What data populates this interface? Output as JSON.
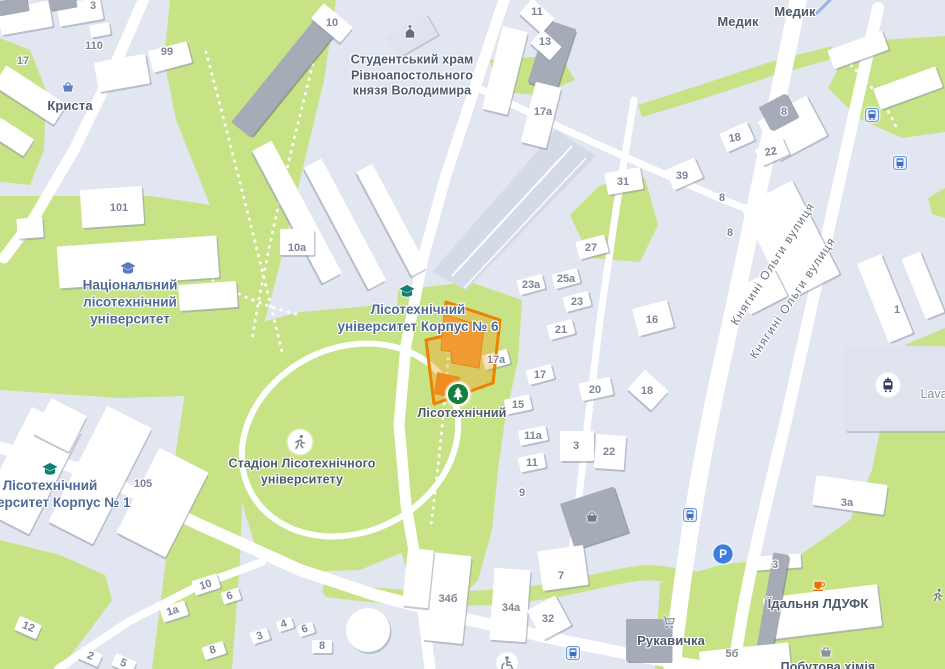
{
  "map": {
    "colors": {
      "background": "#e2e6f1",
      "green": "#c7e386",
      "road": "#ffffff",
      "building": "#ffffff",
      "building_dark": "#a6abb8",
      "tram_corridor": "#d5dae7",
      "selected_stroke": "#ee8100",
      "selected_fill": "rgba(244,160,36,0.38)",
      "selected_building": "#f09c33",
      "poi_text": "#4d5a6b",
      "university_text": "#4f6a97",
      "number_text": "#7f8596"
    },
    "poi_labels": [
      {
        "name": "poi-krysta",
        "text": "Криста",
        "x": 70,
        "y": 106,
        "size": 13,
        "cls": "poi"
      },
      {
        "name": "poi-student-church",
        "text": "Студентський храм\nРівноапостольного\nкнязя Володимира",
        "x": 412,
        "y": 76,
        "size": 12.5,
        "cls": "poi"
      },
      {
        "name": "poi-medyk-1",
        "text": "Медик",
        "x": 738,
        "y": 22,
        "size": 13,
        "cls": "poi"
      },
      {
        "name": "poi-medyk-2",
        "text": "Медик",
        "x": 795,
        "y": 12,
        "size": 13,
        "cls": "poi"
      },
      {
        "name": "poi-national-forestry-university",
        "text": "Національний\nлісотехнічний\nуніверситет",
        "x": 130,
        "y": 303,
        "size": 13.5,
        "cls": "univ"
      },
      {
        "name": "poi-forestry-university-korpus-6",
        "text": "Лісотехнічний\nуніверситет Корпус № 6",
        "x": 418,
        "y": 319,
        "size": 13.5,
        "cls": "univ"
      },
      {
        "name": "poi-lisotekhnichnyi",
        "text": "Лісотехнічний",
        "x": 462,
        "y": 414,
        "size": 12.5,
        "cls": "poi"
      },
      {
        "name": "poi-stadium",
        "text": "Стадіон Лісотехнічного\nуніверситету",
        "x": 302,
        "y": 472,
        "size": 12.5,
        "cls": "poi"
      },
      {
        "name": "poi-forestry-university-korpus-1",
        "text": "Лісотехнічний\nуніверситет Корпус № 1",
        "x": 50,
        "y": 495,
        "size": 13.5,
        "cls": "univ"
      },
      {
        "name": "poi-yidalnia-ldufk",
        "text": "Їдальня ЛДУФК",
        "x": 818,
        "y": 604,
        "size": 13,
        "cls": "poi"
      },
      {
        "name": "poi-rukavychka",
        "text": "Рукавичка",
        "x": 671,
        "y": 641,
        "size": 13,
        "cls": "poi"
      },
      {
        "name": "poi-pobutova-khimiia",
        "text": "Побутова хімія",
        "x": 828,
        "y": 668,
        "size": 12.5,
        "cls": "poi"
      },
      {
        "name": "poi-lava",
        "text": "Lava",
        "x": 934,
        "y": 395,
        "size": 12.5,
        "cls": "muted"
      }
    ],
    "street_labels": [
      {
        "name": "street-kniahyni-olhy-1",
        "text": "Княгині Ольги вулиця",
        "x": 773,
        "y": 264,
        "rot": -57,
        "size": 12
      },
      {
        "name": "street-kniahyni-olhy-2",
        "text": "Княгині Ольги вулиця",
        "x": 793,
        "y": 298,
        "rot": -56,
        "size": 12
      }
    ],
    "house_numbers": [
      {
        "t": "3",
        "x": 93,
        "y": 7
      },
      {
        "t": "110",
        "x": 94,
        "y": 47
      },
      {
        "t": "17",
        "x": 23,
        "y": 62
      },
      {
        "t": "99",
        "x": 167,
        "y": 53
      },
      {
        "t": "10",
        "x": 332,
        "y": 24
      },
      {
        "t": "11",
        "x": 537,
        "y": 13
      },
      {
        "t": "13",
        "x": 545,
        "y": 43
      },
      {
        "t": "17а",
        "x": 543,
        "y": 113
      },
      {
        "t": "8",
        "x": 784,
        "y": 113
      },
      {
        "t": "18",
        "x": 735,
        "y": 139,
        "r": -10
      },
      {
        "t": "22",
        "x": 771,
        "y": 153,
        "r": -10
      },
      {
        "t": "39",
        "x": 682,
        "y": 177
      },
      {
        "t": "31",
        "x": 623,
        "y": 183
      },
      {
        "t": "8",
        "x": 722,
        "y": 199
      },
      {
        "t": "8",
        "x": 730,
        "y": 234
      },
      {
        "t": "101",
        "x": 119,
        "y": 209
      },
      {
        "t": "10а",
        "x": 297,
        "y": 249
      },
      {
        "t": "27",
        "x": 591,
        "y": 249
      },
      {
        "t": "25а",
        "x": 566,
        "y": 280
      },
      {
        "t": "23а",
        "x": 531,
        "y": 286
      },
      {
        "t": "23",
        "x": 577,
        "y": 303
      },
      {
        "t": "1",
        "x": 897,
        "y": 311
      },
      {
        "t": "21",
        "x": 561,
        "y": 331
      },
      {
        "t": "16",
        "x": 652,
        "y": 321
      },
      {
        "t": "17а",
        "x": 496,
        "y": 361
      },
      {
        "t": "17",
        "x": 540,
        "y": 376
      },
      {
        "t": "20",
        "x": 595,
        "y": 391
      },
      {
        "t": "18",
        "x": 647,
        "y": 392
      },
      {
        "t": "15",
        "x": 518,
        "y": 406
      },
      {
        "t": "11а",
        "x": 533,
        "y": 437
      },
      {
        "t": "3",
        "x": 576,
        "y": 447
      },
      {
        "t": "22",
        "x": 609,
        "y": 453
      },
      {
        "t": "11",
        "x": 532,
        "y": 464
      },
      {
        "t": "105",
        "x": 143,
        "y": 485
      },
      {
        "t": "9",
        "x": 522,
        "y": 494
      },
      {
        "t": "3а",
        "x": 847,
        "y": 504
      },
      {
        "t": "3",
        "x": 775,
        "y": 566
      },
      {
        "t": "7",
        "x": 561,
        "y": 577
      },
      {
        "t": "10",
        "x": 206,
        "y": 586,
        "r": -18
      },
      {
        "t": "34б",
        "x": 448,
        "y": 600
      },
      {
        "t": "6",
        "x": 230,
        "y": 597,
        "r": -18
      },
      {
        "t": "34а",
        "x": 511,
        "y": 609
      },
      {
        "t": "1а",
        "x": 173,
        "y": 612,
        "r": -18
      },
      {
        "t": "32",
        "x": 548,
        "y": 620
      },
      {
        "t": "12",
        "x": 28,
        "y": 628,
        "r": 22
      },
      {
        "t": "4",
        "x": 284,
        "y": 625,
        "r": -18
      },
      {
        "t": "6",
        "x": 305,
        "y": 630,
        "r": -18
      },
      {
        "t": "3",
        "x": 260,
        "y": 637,
        "r": -18
      },
      {
        "t": "8",
        "x": 213,
        "y": 651,
        "r": -18
      },
      {
        "t": "2",
        "x": 90,
        "y": 657,
        "r": 22
      },
      {
        "t": "5",
        "x": 123,
        "y": 664,
        "r": 22
      },
      {
        "t": "8",
        "x": 322,
        "y": 647
      },
      {
        "t": "5б",
        "x": 732,
        "y": 655
      }
    ],
    "icons": [
      {
        "type": "education",
        "x": 128,
        "y": 269,
        "color": "#5b7bc0",
        "name": "education-icon"
      },
      {
        "type": "education",
        "x": 407,
        "y": 292,
        "color": "#0e8174",
        "name": "education-icon"
      },
      {
        "type": "education",
        "x": 50,
        "y": 470,
        "color": "#0e8174",
        "name": "education-icon"
      },
      {
        "type": "church",
        "x": 410,
        "y": 32,
        "color": "#646b7a",
        "name": "church-icon"
      },
      {
        "type": "tree",
        "x": 458,
        "y": 394,
        "color": "#157f3c",
        "name": "park-tree-icon"
      },
      {
        "type": "runnercircle",
        "x": 300,
        "y": 442,
        "color": "#7b8292",
        "name": "stadium-runner-icon"
      },
      {
        "type": "basket",
        "x": 68,
        "y": 87,
        "color": "#5b80c6",
        "name": "shopping-basket-icon"
      },
      {
        "type": "basket",
        "x": 592,
        "y": 517,
        "color": "#70798c",
        "name": "shopping-basket-icon"
      },
      {
        "type": "basket",
        "x": 826,
        "y": 652,
        "color": "#8a91a0",
        "name": "shopping-basket-icon"
      },
      {
        "type": "cart",
        "x": 669,
        "y": 622,
        "color": "#8a91a0",
        "name": "shopping-cart-icon"
      },
      {
        "type": "cup",
        "x": 819,
        "y": 585,
        "color": "#e8710a",
        "name": "cafe-cup-icon"
      },
      {
        "type": "parking",
        "x": 723,
        "y": 554,
        "color": "#3d7de0",
        "name": "parking-icon"
      },
      {
        "type": "tram",
        "x": 888,
        "y": 385,
        "color": "#323c63",
        "name": "tram-stop-icon"
      },
      {
        "type": "bus",
        "x": 872,
        "y": 115,
        "color": "#3f6fc4",
        "name": "bus-stop-icon"
      },
      {
        "type": "bus",
        "x": 900,
        "y": 163,
        "color": "#3f6fc4",
        "name": "bus-stop-icon"
      },
      {
        "type": "bus",
        "x": 690,
        "y": 515,
        "color": "#3f6fc4",
        "name": "bus-stop-icon"
      },
      {
        "type": "bus",
        "x": 573,
        "y": 653,
        "color": "#3f6fc4",
        "name": "bus-stop-icon"
      },
      {
        "type": "runner",
        "x": 938,
        "y": 595,
        "color": "#6f7680",
        "name": "sports-runner-icon"
      },
      {
        "type": "access",
        "x": 507,
        "y": 663,
        "color": "#7b8292",
        "name": "accessibility-icon"
      }
    ]
  }
}
